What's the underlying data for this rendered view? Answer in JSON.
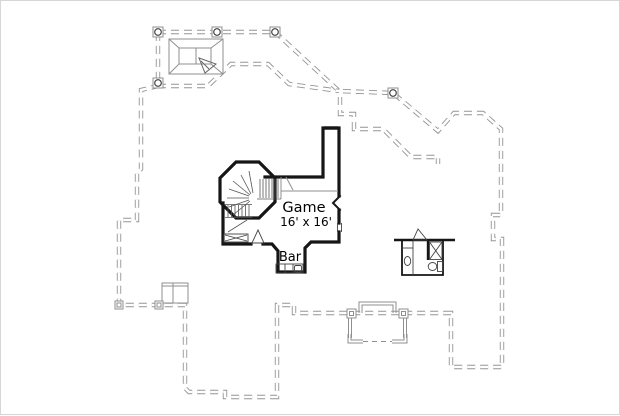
{
  "labels": {
    "room_name": "Game",
    "room_size": "16' x 16'",
    "bar": "Bar"
  },
  "colors": {
    "background": "#ffffff",
    "frame_border": "#d6d6d6",
    "dashed_roof_outline": "#949494",
    "solid_walls": "#161616",
    "light_detail_lines": "#8f8f8f",
    "fixture_lines": "#444444",
    "text": "#000000"
  },
  "features": [
    "lower-floor-dashed-outline",
    "porch-columns",
    "skylight-roof-detail",
    "octagonal-stair-turret",
    "curved-staircase",
    "straight-staircase",
    "game-room",
    "bar-nook",
    "bar-counter-with-sink",
    "bathroom",
    "shower",
    "toilet",
    "vanity-sink",
    "door-swings",
    "chimney",
    "bay-window-footprint",
    "window-openings"
  ]
}
